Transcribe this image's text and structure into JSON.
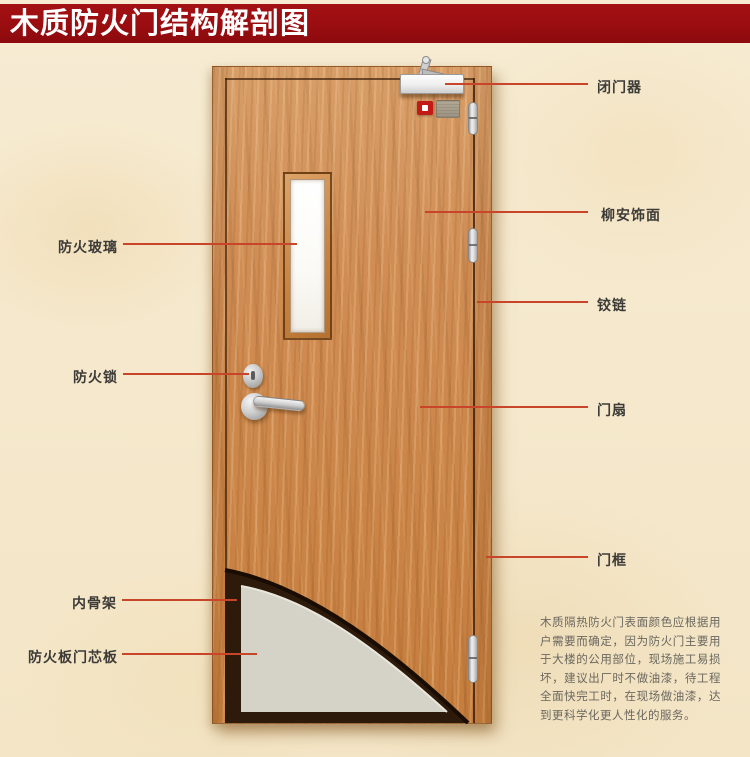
{
  "title": {
    "text": "木质防火门结构解剖图"
  },
  "labels": {
    "left": [
      {
        "text": "防火玻璃"
      },
      {
        "text": "防火锁"
      },
      {
        "text": "内骨架"
      },
      {
        "text": "防火板门芯板"
      }
    ],
    "right": [
      {
        "text": "闭门器"
      },
      {
        "text": "柳安饰面"
      },
      {
        "text": "铰链"
      },
      {
        "text": "门扇"
      },
      {
        "text": "门框"
      }
    ]
  },
  "description": {
    "text": "木质隔热防火门表面颜色应根据用户需要而确定，因为防火门主要用于大楼的公用部位，现场施工易损坏，建议出厂时不做油漆，待工程全面快完工时，在现场做油漆，达到更科学化更人性化的服务。"
  },
  "colors": {
    "page_bg": "#f6ead0",
    "banner_bg": "#9a0d10",
    "banner_text": "#ffffff",
    "pointer_line": "#c9452a",
    "label_text": "#3d3b38",
    "paragraph_text": "#6a675f",
    "door_wood": "#cd8a52",
    "door_core_gray": "#d5d2c8",
    "inner_frame_dark": "#2d1a0a"
  }
}
